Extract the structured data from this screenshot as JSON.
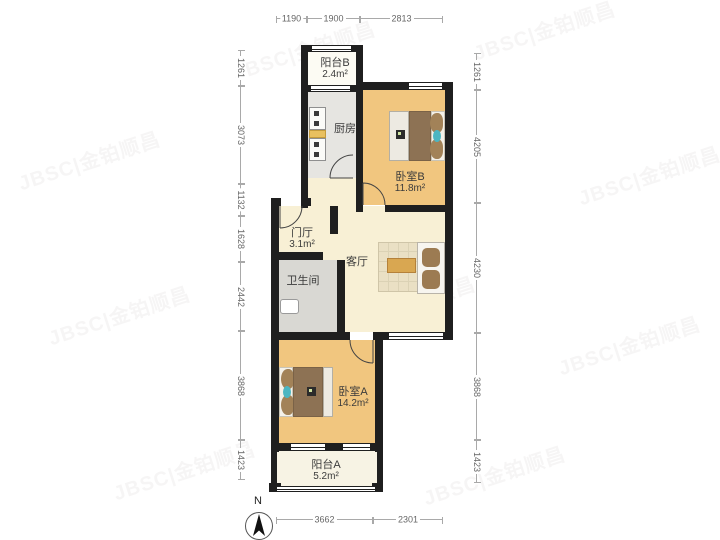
{
  "watermark": {
    "text": "JBSC|金铂顺昌"
  },
  "compass": {
    "north_label": "N"
  },
  "rooms": [
    {
      "id": "balcony-b",
      "name": "阳台B",
      "area": "2.4m²"
    },
    {
      "id": "kitchen",
      "name": "厨房",
      "area": ""
    },
    {
      "id": "bedroom-b",
      "name": "卧室B",
      "area": "11.8m²"
    },
    {
      "id": "foyer",
      "name": "门厅",
      "area": "3.1m²"
    },
    {
      "id": "living-room",
      "name": "客厅",
      "area": ""
    },
    {
      "id": "bathroom",
      "name": "卫生间",
      "area": ""
    },
    {
      "id": "bedroom-a",
      "name": "卧室A",
      "area": "14.2m²"
    },
    {
      "id": "balcony-a",
      "name": "阳台A",
      "area": "5.2m²"
    }
  ],
  "dimensions_mm": {
    "top": [
      {
        "value": "1190"
      },
      {
        "value": "1900"
      },
      {
        "value": "2813"
      }
    ],
    "bottom": [
      {
        "value": "3662"
      },
      {
        "value": "2301"
      }
    ],
    "left": [
      {
        "value": "1261"
      },
      {
        "value": "3073"
      },
      {
        "value": "1132"
      },
      {
        "value": "1628"
      },
      {
        "value": "2442"
      },
      {
        "value": "3868"
      },
      {
        "value": "1423"
      }
    ],
    "right": [
      {
        "value": "1261"
      },
      {
        "value": "4205"
      },
      {
        "value": "4230"
      },
      {
        "value": "3868"
      },
      {
        "value": "1423"
      }
    ]
  },
  "colors": {
    "wall": "#1f1f1f",
    "bedroom_floor": "#f1c67f",
    "living_floor": "#f8f0d5",
    "kitchen_floor": "#e6e5e1",
    "bathroom_floor": "#d9d8d3",
    "balcony_floor": "#f7f3e4",
    "blanket_brown": "#8d7254",
    "accent_teal": "#4cb6c2",
    "table_tan": "#d9a751",
    "dimension_gray": "#a9a9a9"
  }
}
